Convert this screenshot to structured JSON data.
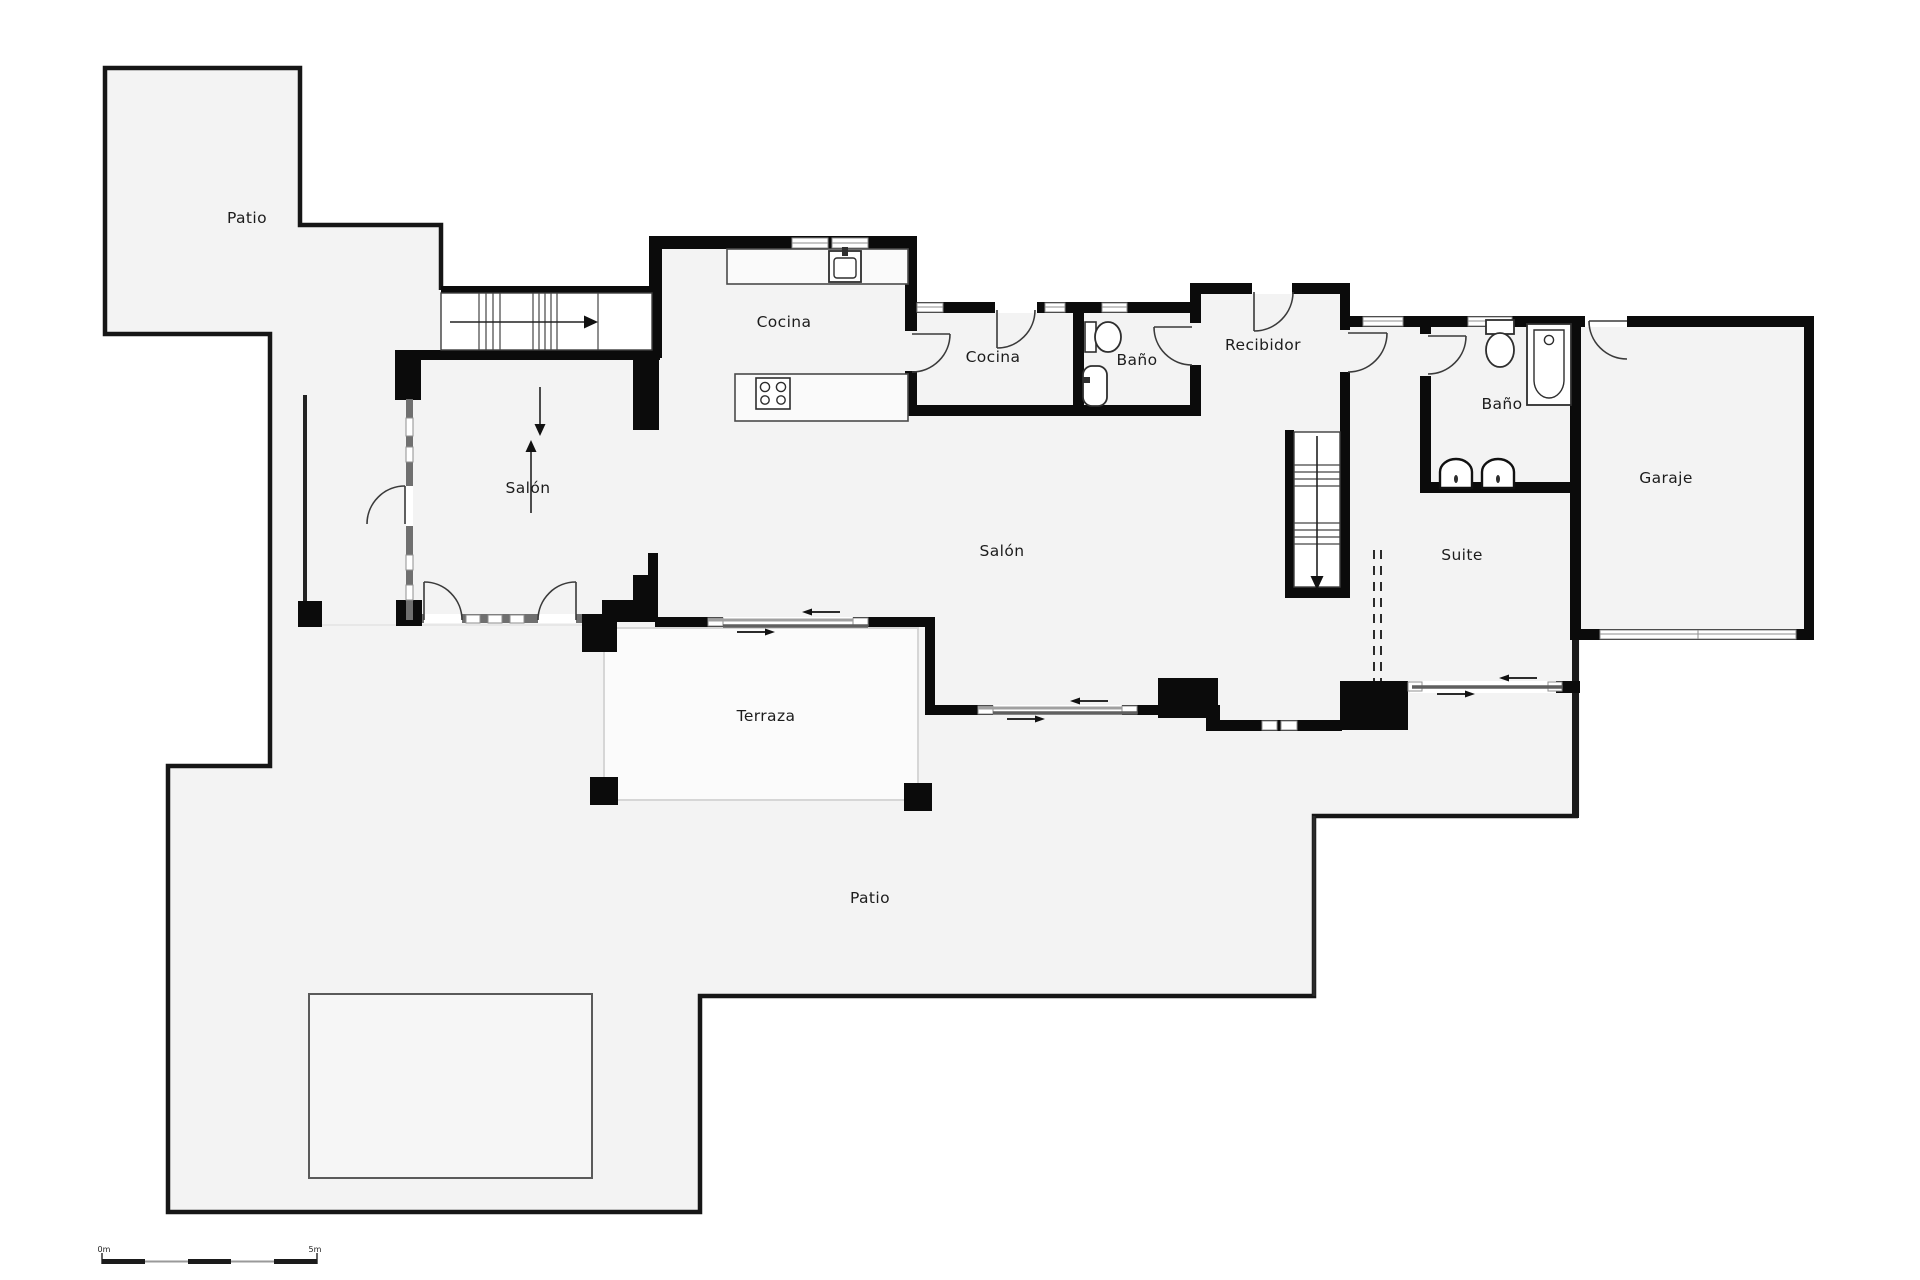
{
  "title": "Plano de planta",
  "rooms": [
    {
      "id": "patio-top",
      "label": "Patio"
    },
    {
      "id": "salon-left",
      "label": "Salón"
    },
    {
      "id": "cocina-main",
      "label": "Cocina"
    },
    {
      "id": "cocina-small",
      "label": "Cocina"
    },
    {
      "id": "bano-small",
      "label": "Baño"
    },
    {
      "id": "recibidor",
      "label": "Recibidor"
    },
    {
      "id": "bano-suite",
      "label": "Baño"
    },
    {
      "id": "garaje",
      "label": "Garaje"
    },
    {
      "id": "salon-main",
      "label": "Salón"
    },
    {
      "id": "suite",
      "label": "Suite"
    },
    {
      "id": "terraza",
      "label": "Terraza"
    },
    {
      "id": "patio-bottom",
      "label": "Patio"
    }
  ],
  "scale_bar": {
    "start_label": "0m",
    "end_label": "5m"
  },
  "icons": [
    "sink-icon",
    "stove-icon",
    "toilet-icon",
    "bidet-icon",
    "bathtub-icon",
    "washbasin-icon",
    "stairs-up-arrow",
    "stairs-down-arrow",
    "sliding-door-arrows"
  ],
  "colors": {
    "wall": "#0b0b0b",
    "floor": "#f3f3f3",
    "terrace": "#fbfbfb",
    "window": "#8f8f8f",
    "stairs": "#ffffff"
  }
}
